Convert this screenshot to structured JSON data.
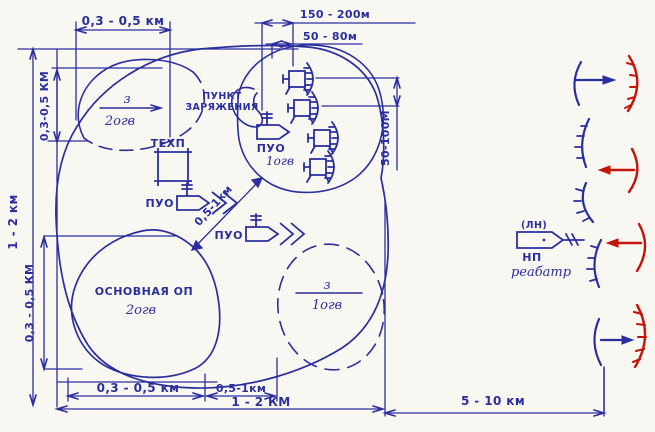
{
  "colors": {
    "ink": "#2b2f9e",
    "enemy": "#c4150d",
    "paper": "#f9f7f1"
  },
  "dims": {
    "top_left": "0,3 - 0,5 км",
    "top_right_upper": "150 - 200м",
    "top_right_lower": "50 - 80м",
    "left_outer": "1 - 2 км",
    "left_inner": "0,3-0,5 КМ",
    "left_lower": "0,3 - 0,5 КМ",
    "launcher_spacing": "50-100М",
    "diagonal": "0,5-1км",
    "bottom_first": "0,3 - 0,5 км",
    "bottom_second": "0,5-1км",
    "bottom_total": "1 - 2 КМ",
    "to_frontline": "5 - 10 км"
  },
  "areas": {
    "reserve_op_2": {
      "numerator": "з",
      "denominator": "2огв"
    },
    "reserve_op_1": {
      "numerator": "з",
      "denominator": "1огв"
    },
    "main_op": {
      "line1": "ОСНОВНАЯ ОП",
      "line2": "2огв"
    },
    "charging_point": {
      "line1": "ПУНКТ",
      "line2": "ЗАРЯЖЕНИЯ"
    }
  },
  "units": {
    "tech_point": "ТЕХП",
    "puo_left": "ПУО",
    "puo_center": "ПУО",
    "puo_battery_line1": "ПУО",
    "puo_battery_line2": "1огв",
    "np_callsign": "(ЛН)",
    "np_label": "НП",
    "np_unit": "реабатр"
  }
}
